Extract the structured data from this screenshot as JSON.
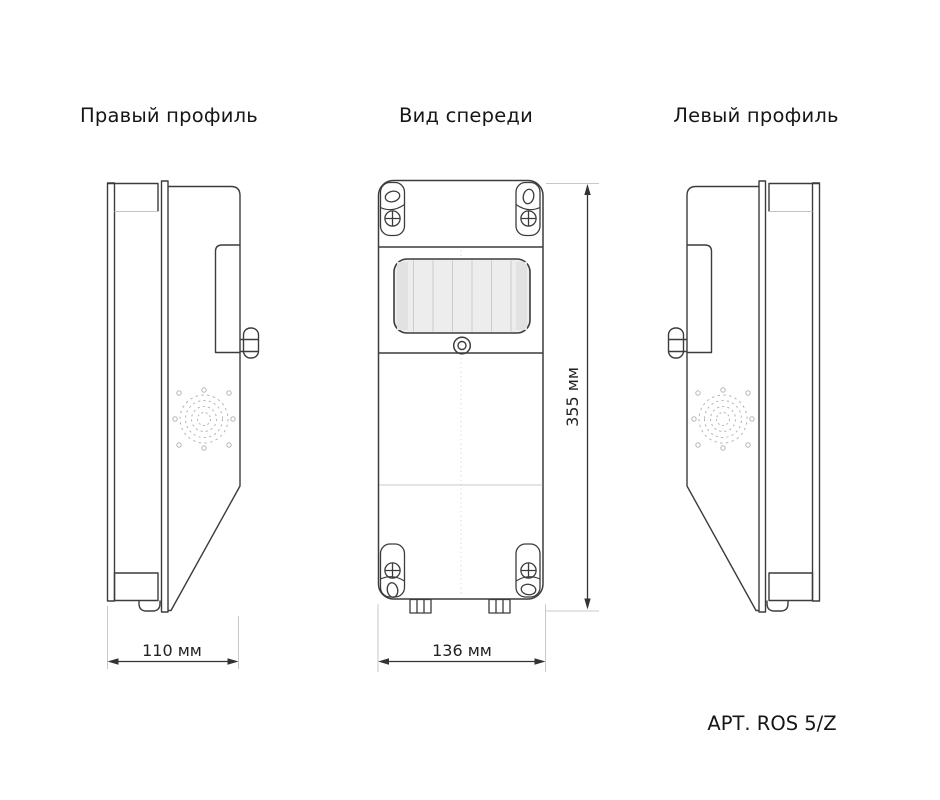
{
  "document": {
    "type_label": "technical drawing, three orthographic views of wall-mount enclosure",
    "article_label": "АРТ. ROS 5/Z",
    "background": "#ffffff"
  },
  "views": {
    "right_profile": {
      "title": "Правый профиль",
      "width_label": "110 мм"
    },
    "front": {
      "title": "Вид спереди",
      "width_label": "136 мм",
      "height_label": "355 мм"
    },
    "left_profile": {
      "title": "Левый профиль"
    }
  },
  "colors": {
    "outline": "#3c3c3c",
    "extension_line": "#c8c8c8",
    "window_fill": "#ededed",
    "window_stripe": "#cbcbcb",
    "grille": "#b5b5b5",
    "dimension_text": "#222222",
    "title_text": "#161616"
  }
}
